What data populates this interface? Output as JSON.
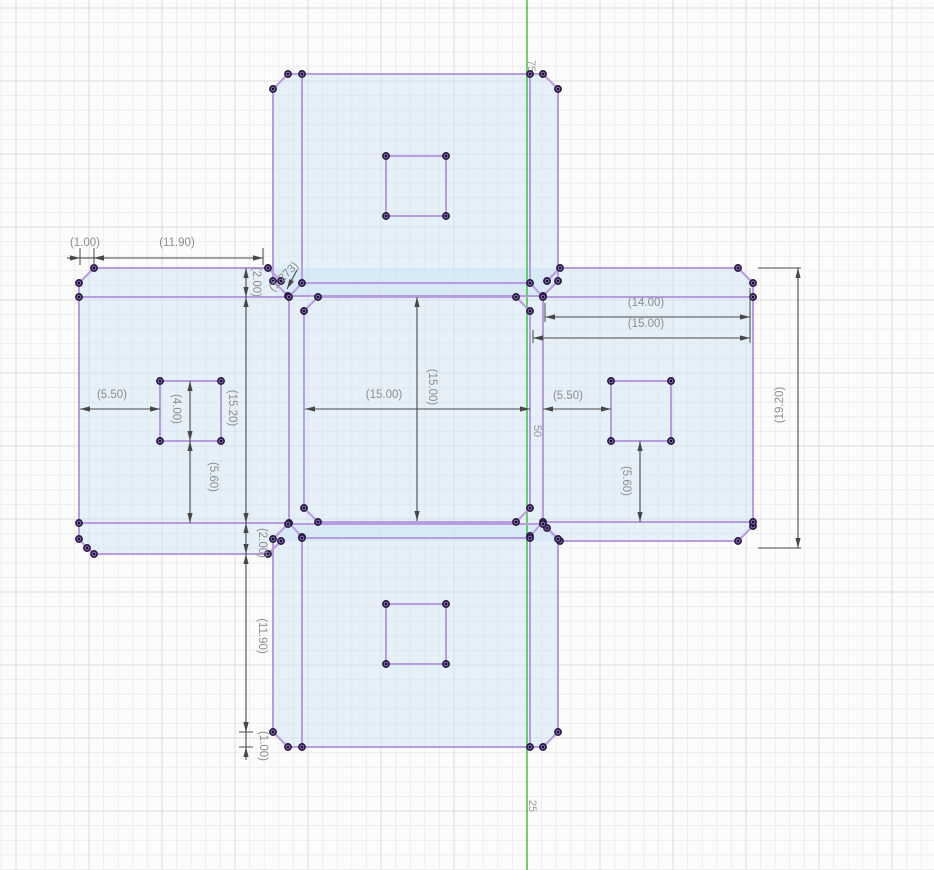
{
  "canvas": {
    "width": 934,
    "height": 870,
    "bg": "#fcfcfc",
    "grid_minor_color": "#ededed",
    "grid_major_color": "#dddddd",
    "axis_color": "#3fc43f",
    "axis_text_color": "#9a9a9a",
    "plate_fill": "rgba(205,228,246,0.5)",
    "sketch_stroke": "#b79ce0",
    "point_fill": "#8b6cc4",
    "point_ring": "#2b1b40",
    "point_core": "#170d26",
    "dim_line_color": "#474747",
    "dim_text_color": "#8d8d8d",
    "dim_font_size": 11.5,
    "axis_font_size": 11
  },
  "grid": {
    "minor": 14.6,
    "per_major": 5,
    "origin_x": 527,
    "origin_y": 81
  },
  "axis": {
    "x": 527,
    "labels": [
      {
        "text": "75",
        "x": 531,
        "y": 66
      },
      {
        "text": "50",
        "x": 537,
        "y": 431
      },
      {
        "text": "25",
        "x": 532,
        "y": 806
      }
    ]
  },
  "sketch": {
    "fills": [
      "M288,74 L543,74 L558,89 L558,281 L543,296 L288,296 L273,281 L273,89 Z",
      "M94,268 L738,268 L753,283 L753,526 L738,541 L268,541 L268,554 L94,554 L79,539 L79,283 Z",
      "M288,524 L543,524 L558,539 L558,732 L543,747 L288,747 L273,732 L273,539 Z"
    ],
    "segments": [
      [
        288,
        74,
        543,
        74
      ],
      [
        288,
        74,
        273,
        89
      ],
      [
        543,
        74,
        558,
        89
      ],
      [
        273,
        89,
        273,
        281
      ],
      [
        558,
        89,
        558,
        281
      ],
      [
        273,
        281,
        288,
        296
      ],
      [
        558,
        281,
        543,
        296
      ],
      [
        288,
        296,
        543,
        296
      ],
      [
        302,
        74,
        302,
        283
      ],
      [
        530,
        74,
        530,
        283
      ],
      [
        302,
        283,
        530,
        283
      ],
      [
        94,
        268,
        268,
        268
      ],
      [
        94,
        268,
        79,
        283
      ],
      [
        268,
        268,
        281,
        281
      ],
      [
        79,
        283,
        79,
        539
      ],
      [
        79,
        539,
        87,
        548
      ],
      [
        87,
        548,
        94,
        554
      ],
      [
        94,
        554,
        268,
        554
      ],
      [
        268,
        554,
        281,
        541
      ],
      [
        79,
        297,
        289,
        297
      ],
      [
        79,
        523,
        289,
        523
      ],
      [
        289,
        297,
        289,
        523
      ],
      [
        289,
        297,
        302,
        283
      ],
      [
        289,
        523,
        302,
        537
      ],
      [
        560,
        268,
        738,
        268
      ],
      [
        738,
        268,
        753,
        283
      ],
      [
        560,
        268,
        547,
        281
      ],
      [
        753,
        283,
        753,
        526
      ],
      [
        753,
        526,
        738,
        541
      ],
      [
        560,
        541,
        738,
        541
      ],
      [
        560,
        541,
        547,
        528
      ],
      [
        543,
        297,
        753,
        297
      ],
      [
        543,
        522,
        753,
        522
      ],
      [
        543,
        297,
        543,
        522
      ],
      [
        543,
        297,
        530,
        283
      ],
      [
        543,
        522,
        530,
        536
      ],
      [
        318,
        297,
        516,
        297
      ],
      [
        318,
        297,
        304,
        311
      ],
      [
        516,
        297,
        530,
        311
      ],
      [
        304,
        311,
        304,
        508
      ],
      [
        530,
        311,
        530,
        508
      ],
      [
        304,
        508,
        318,
        522
      ],
      [
        530,
        508,
        516,
        522
      ],
      [
        318,
        522,
        516,
        522
      ],
      [
        288,
        747,
        543,
        747
      ],
      [
        288,
        747,
        273,
        732
      ],
      [
        543,
        747,
        558,
        732
      ],
      [
        273,
        539,
        273,
        732
      ],
      [
        558,
        539,
        558,
        732
      ],
      [
        273,
        539,
        288,
        524
      ],
      [
        558,
        539,
        543,
        524
      ],
      [
        288,
        524,
        543,
        524
      ],
      [
        302,
        538,
        302,
        747
      ],
      [
        530,
        538,
        530,
        747
      ],
      [
        302,
        538,
        530,
        538
      ],
      [
        386,
        156,
        446,
        156
      ],
      [
        386,
        216,
        446,
        216
      ],
      [
        386,
        156,
        386,
        216
      ],
      [
        446,
        156,
        446,
        216
      ],
      [
        160,
        381,
        221,
        381
      ],
      [
        160,
        441,
        221,
        441
      ],
      [
        160,
        381,
        160,
        441
      ],
      [
        221,
        381,
        221,
        441
      ],
      [
        611,
        381,
        671,
        381
      ],
      [
        611,
        441,
        671,
        441
      ],
      [
        611,
        381,
        611,
        441
      ],
      [
        671,
        381,
        671,
        441
      ],
      [
        386,
        604,
        446,
        604
      ],
      [
        386,
        664,
        446,
        664
      ],
      [
        386,
        604,
        386,
        664
      ],
      [
        446,
        604,
        446,
        664
      ]
    ],
    "extra_points": []
  },
  "dimensions": {
    "ext_lines": [
      [
        80,
        248,
        80,
        265
      ],
      [
        94,
        248,
        94,
        265
      ],
      [
        263,
        248,
        263,
        265
      ],
      [
        545,
        303,
        545,
        322
      ],
      [
        750,
        288,
        750,
        343
      ],
      [
        533,
        330,
        533,
        343
      ],
      [
        758,
        268,
        801,
        268
      ],
      [
        758,
        548,
        801,
        548
      ],
      [
        239,
        732,
        253,
        732
      ],
      [
        239,
        747,
        253,
        747
      ]
    ],
    "linear": [
      {
        "label": "(1.00)",
        "x1": 80,
        "y1": 258,
        "x2": 94,
        "y2": 258,
        "lx": 85,
        "ly": 243,
        "rot": 0,
        "outside": true
      },
      {
        "label": "(11.90)",
        "x1": 94,
        "y1": 258,
        "x2": 263,
        "y2": 258,
        "lx": 177,
        "ly": 243,
        "rot": 0
      },
      {
        "label": "(2.00)",
        "x1": 246,
        "y1": 268,
        "x2": 246,
        "y2": 297,
        "lx": 256,
        "ly": 282,
        "rot": 90
      },
      {
        "label": "(14.00)",
        "x1": 545,
        "y1": 317,
        "x2": 750,
        "y2": 317,
        "lx": 646,
        "ly": 303,
        "rot": 0
      },
      {
        "label": "(15.00)",
        "x1": 533,
        "y1": 338,
        "x2": 750,
        "y2": 338,
        "lx": 646,
        "ly": 324,
        "rot": 0
      },
      {
        "label": "(15.00)",
        "x1": 305,
        "y1": 409,
        "x2": 530,
        "y2": 409,
        "lx": 384,
        "ly": 395,
        "rot": 0
      },
      {
        "label": "(15.00)",
        "x1": 417,
        "y1": 297,
        "x2": 417,
        "y2": 521,
        "lx": 432,
        "ly": 387,
        "rot": 90
      },
      {
        "label": "(5.50)",
        "x1": 80,
        "y1": 409,
        "x2": 160,
        "y2": 409,
        "lx": 112,
        "ly": 395,
        "rot": 0
      },
      {
        "label": "(5.50)",
        "x1": 543,
        "y1": 409,
        "x2": 611,
        "y2": 409,
        "lx": 568,
        "ly": 396,
        "rot": 0
      },
      {
        "label": "(4.00)",
        "x1": 190,
        "y1": 381,
        "x2": 190,
        "y2": 441,
        "lx": 176,
        "ly": 409,
        "rot": 90
      },
      {
        "label": "(5.60)",
        "x1": 190,
        "y1": 441,
        "x2": 190,
        "y2": 523,
        "lx": 213,
        "ly": 477,
        "rot": 90
      },
      {
        "label": "(5.60)",
        "x1": 640,
        "y1": 441,
        "x2": 640,
        "y2": 522,
        "lx": 626,
        "ly": 481,
        "rot": 90
      },
      {
        "label": "(15.20)",
        "x1": 246,
        "y1": 297,
        "x2": 246,
        "y2": 523,
        "lx": 232,
        "ly": 408,
        "rot": 90
      },
      {
        "label": "(2.00)",
        "x1": 246,
        "y1": 523,
        "x2": 246,
        "y2": 554,
        "lx": 262,
        "ly": 543,
        "rot": 90
      },
      {
        "label": "(11.90)",
        "x1": 246,
        "y1": 554,
        "x2": 246,
        "y2": 732,
        "lx": 262,
        "ly": 636,
        "rot": 90
      },
      {
        "label": "(1.00)",
        "x1": 246,
        "y1": 732,
        "x2": 246,
        "y2": 747,
        "lx": 263,
        "ly": 746,
        "rot": 90,
        "outside": true
      },
      {
        "label": "(19.20)",
        "x1": 798,
        "y1": 268,
        "x2": 798,
        "y2": 548,
        "lx": 780,
        "ly": 405,
        "rot": -90
      }
    ],
    "leader": {
      "label": "(1.273)",
      "tail_x": 297,
      "tail_y": 270,
      "apex_x": 287,
      "apex_y": 289,
      "lx": 284,
      "ly": 277,
      "rot": -45
    }
  }
}
